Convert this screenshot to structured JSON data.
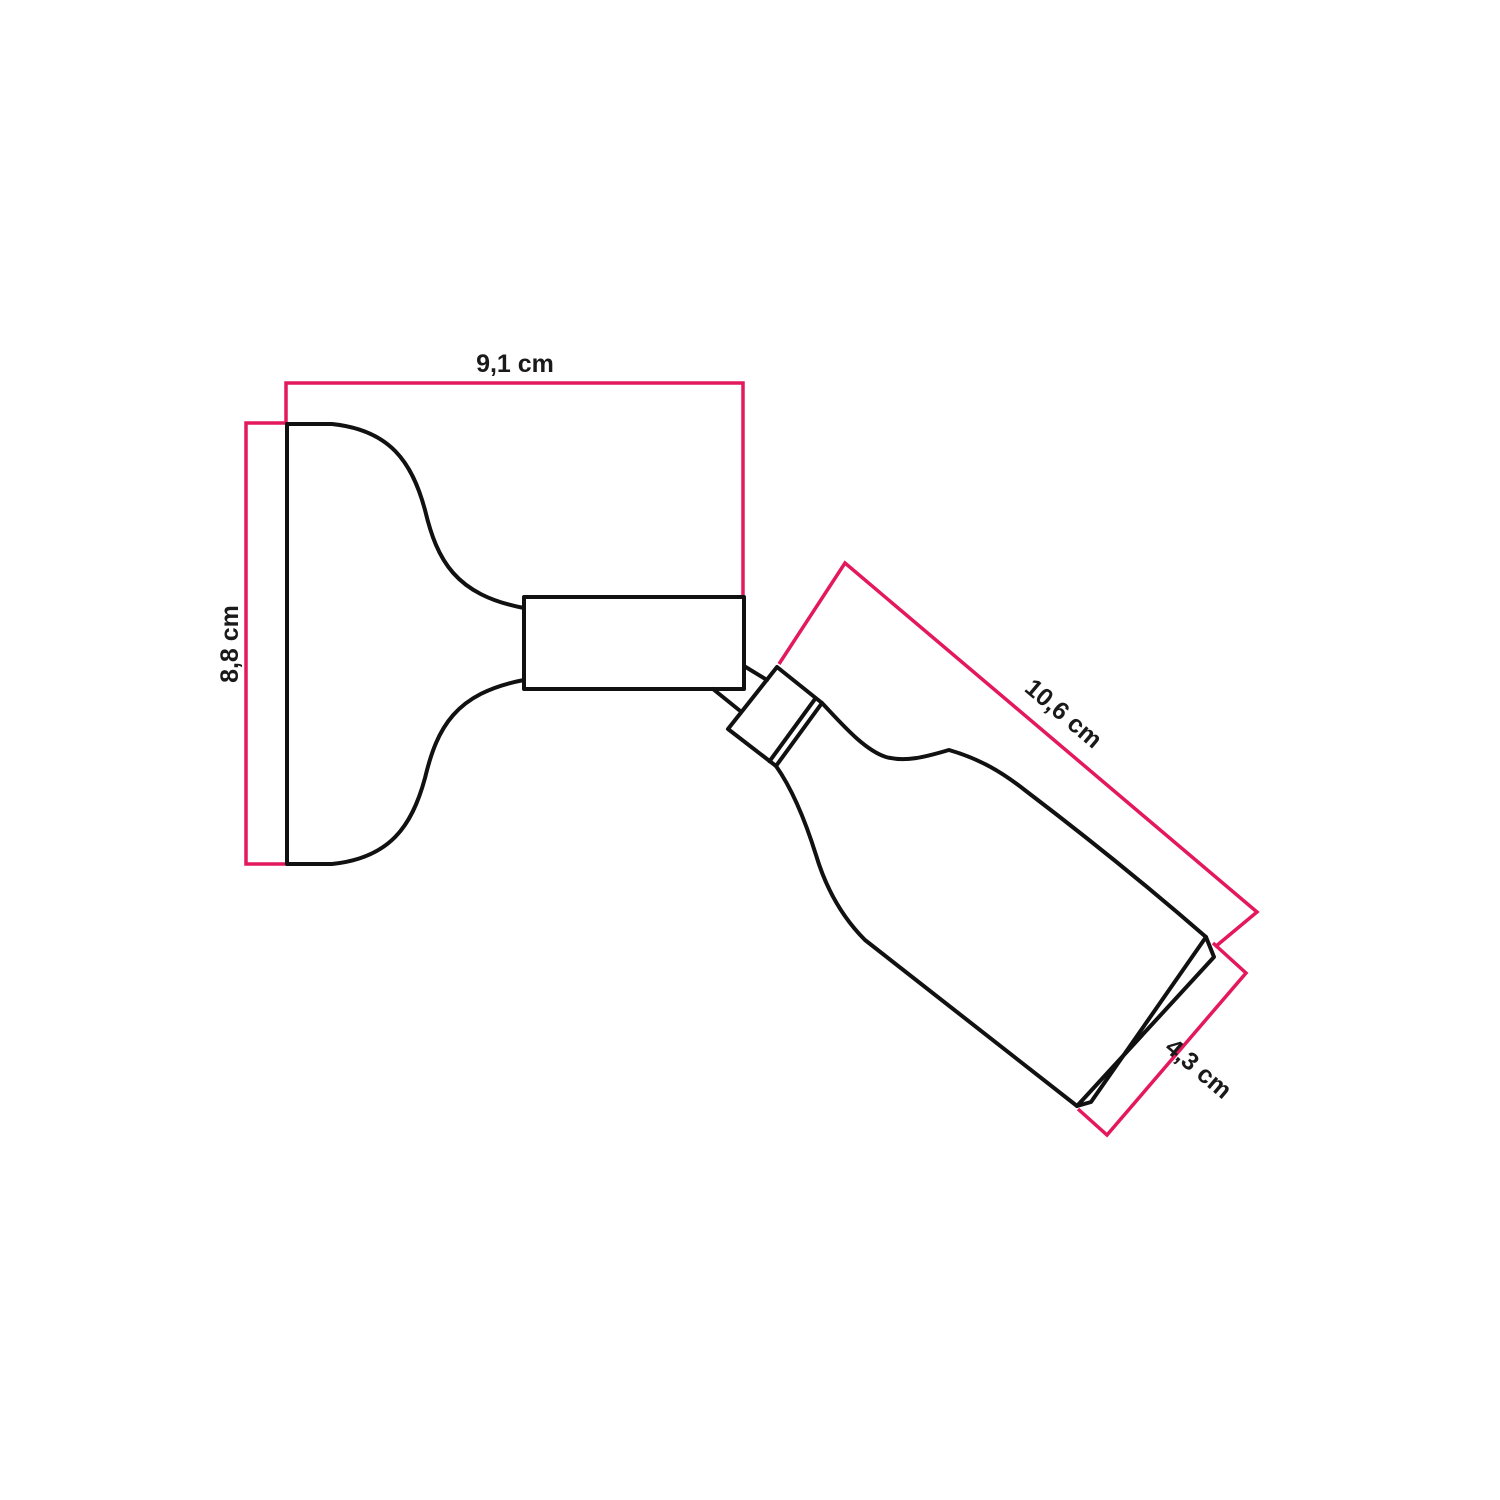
{
  "figure": {
    "background": "#ffffff",
    "colors": {
      "accent": "#e4185c",
      "ink": "#111111",
      "label": "#1a1a1a"
    },
    "dimensions": {
      "plate_width_label": "9,1 cm",
      "plate_height_label": "8,8 cm",
      "holder_length_label": "10,6 cm",
      "holder_opening_label": "4,3 cm"
    }
  }
}
